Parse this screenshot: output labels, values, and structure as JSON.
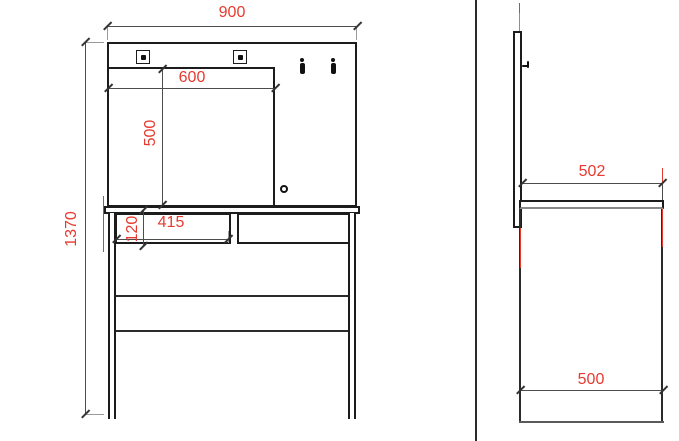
{
  "drawing_title": "dressing-table-two-view-dimension-drawing",
  "views": {
    "front": {
      "overall_width_mm": "900",
      "mirror_width_mm": "600",
      "mirror_height_mm": "500",
      "overall_height_mm": "1370",
      "drawer_width_mm": "415",
      "drawer_height_mm": "120"
    },
    "side": {
      "top_depth_mm": "502",
      "base_depth_mm": "500"
    }
  },
  "colors": {
    "dimension_text": "#e8392f",
    "outline": "#1c1c1c",
    "dimension_line": "#4d4d4d",
    "extension_line": "#9a9a9a",
    "background": "#ffffff"
  }
}
